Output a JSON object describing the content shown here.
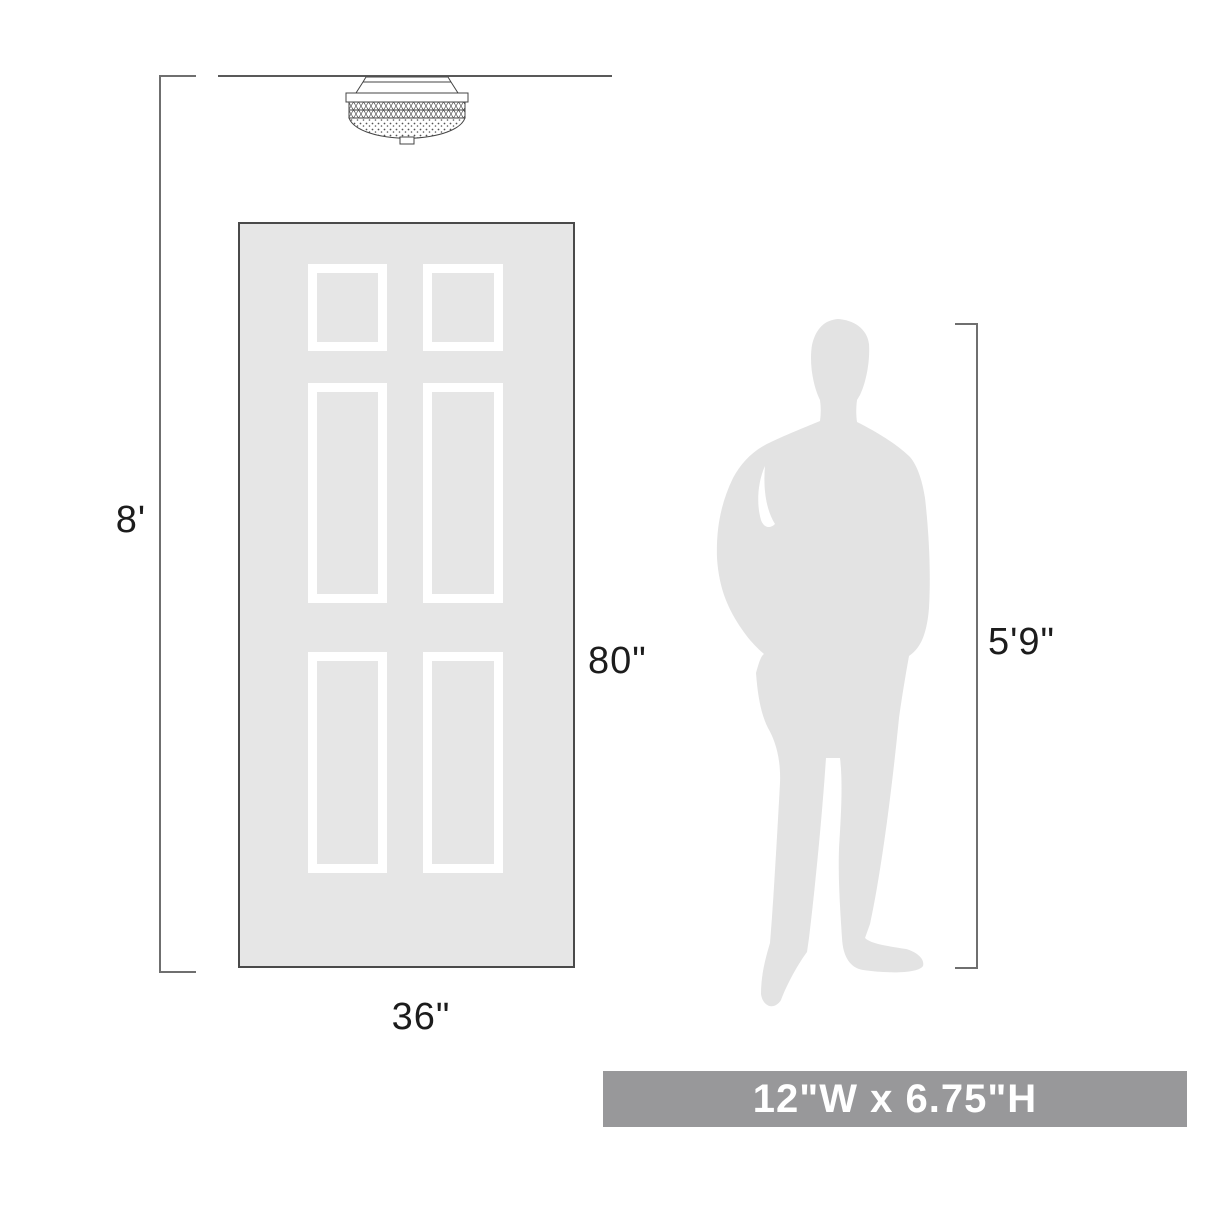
{
  "diagram": {
    "type": "product-scale-diagram",
    "product": "flush mount ceiling light",
    "annotations": {
      "ceiling_height": "8'",
      "door_height": "80\"",
      "door_width": "36\"",
      "person_height": "5'9\""
    },
    "banner": {
      "text": "12\"W x 6.75\"H"
    },
    "colors": {
      "background": "#ffffff",
      "door_fill": "#e6e6e6",
      "door_border": "#4a4a4a",
      "panel_frame": "#ffffff",
      "silhouette": "#e3e3e3",
      "dimension_line": "#6f6f6f",
      "line_art": "#444444",
      "text": "#1c1c1c",
      "banner_bg": "#98989a",
      "banner_fg": "#ffffff"
    }
  }
}
